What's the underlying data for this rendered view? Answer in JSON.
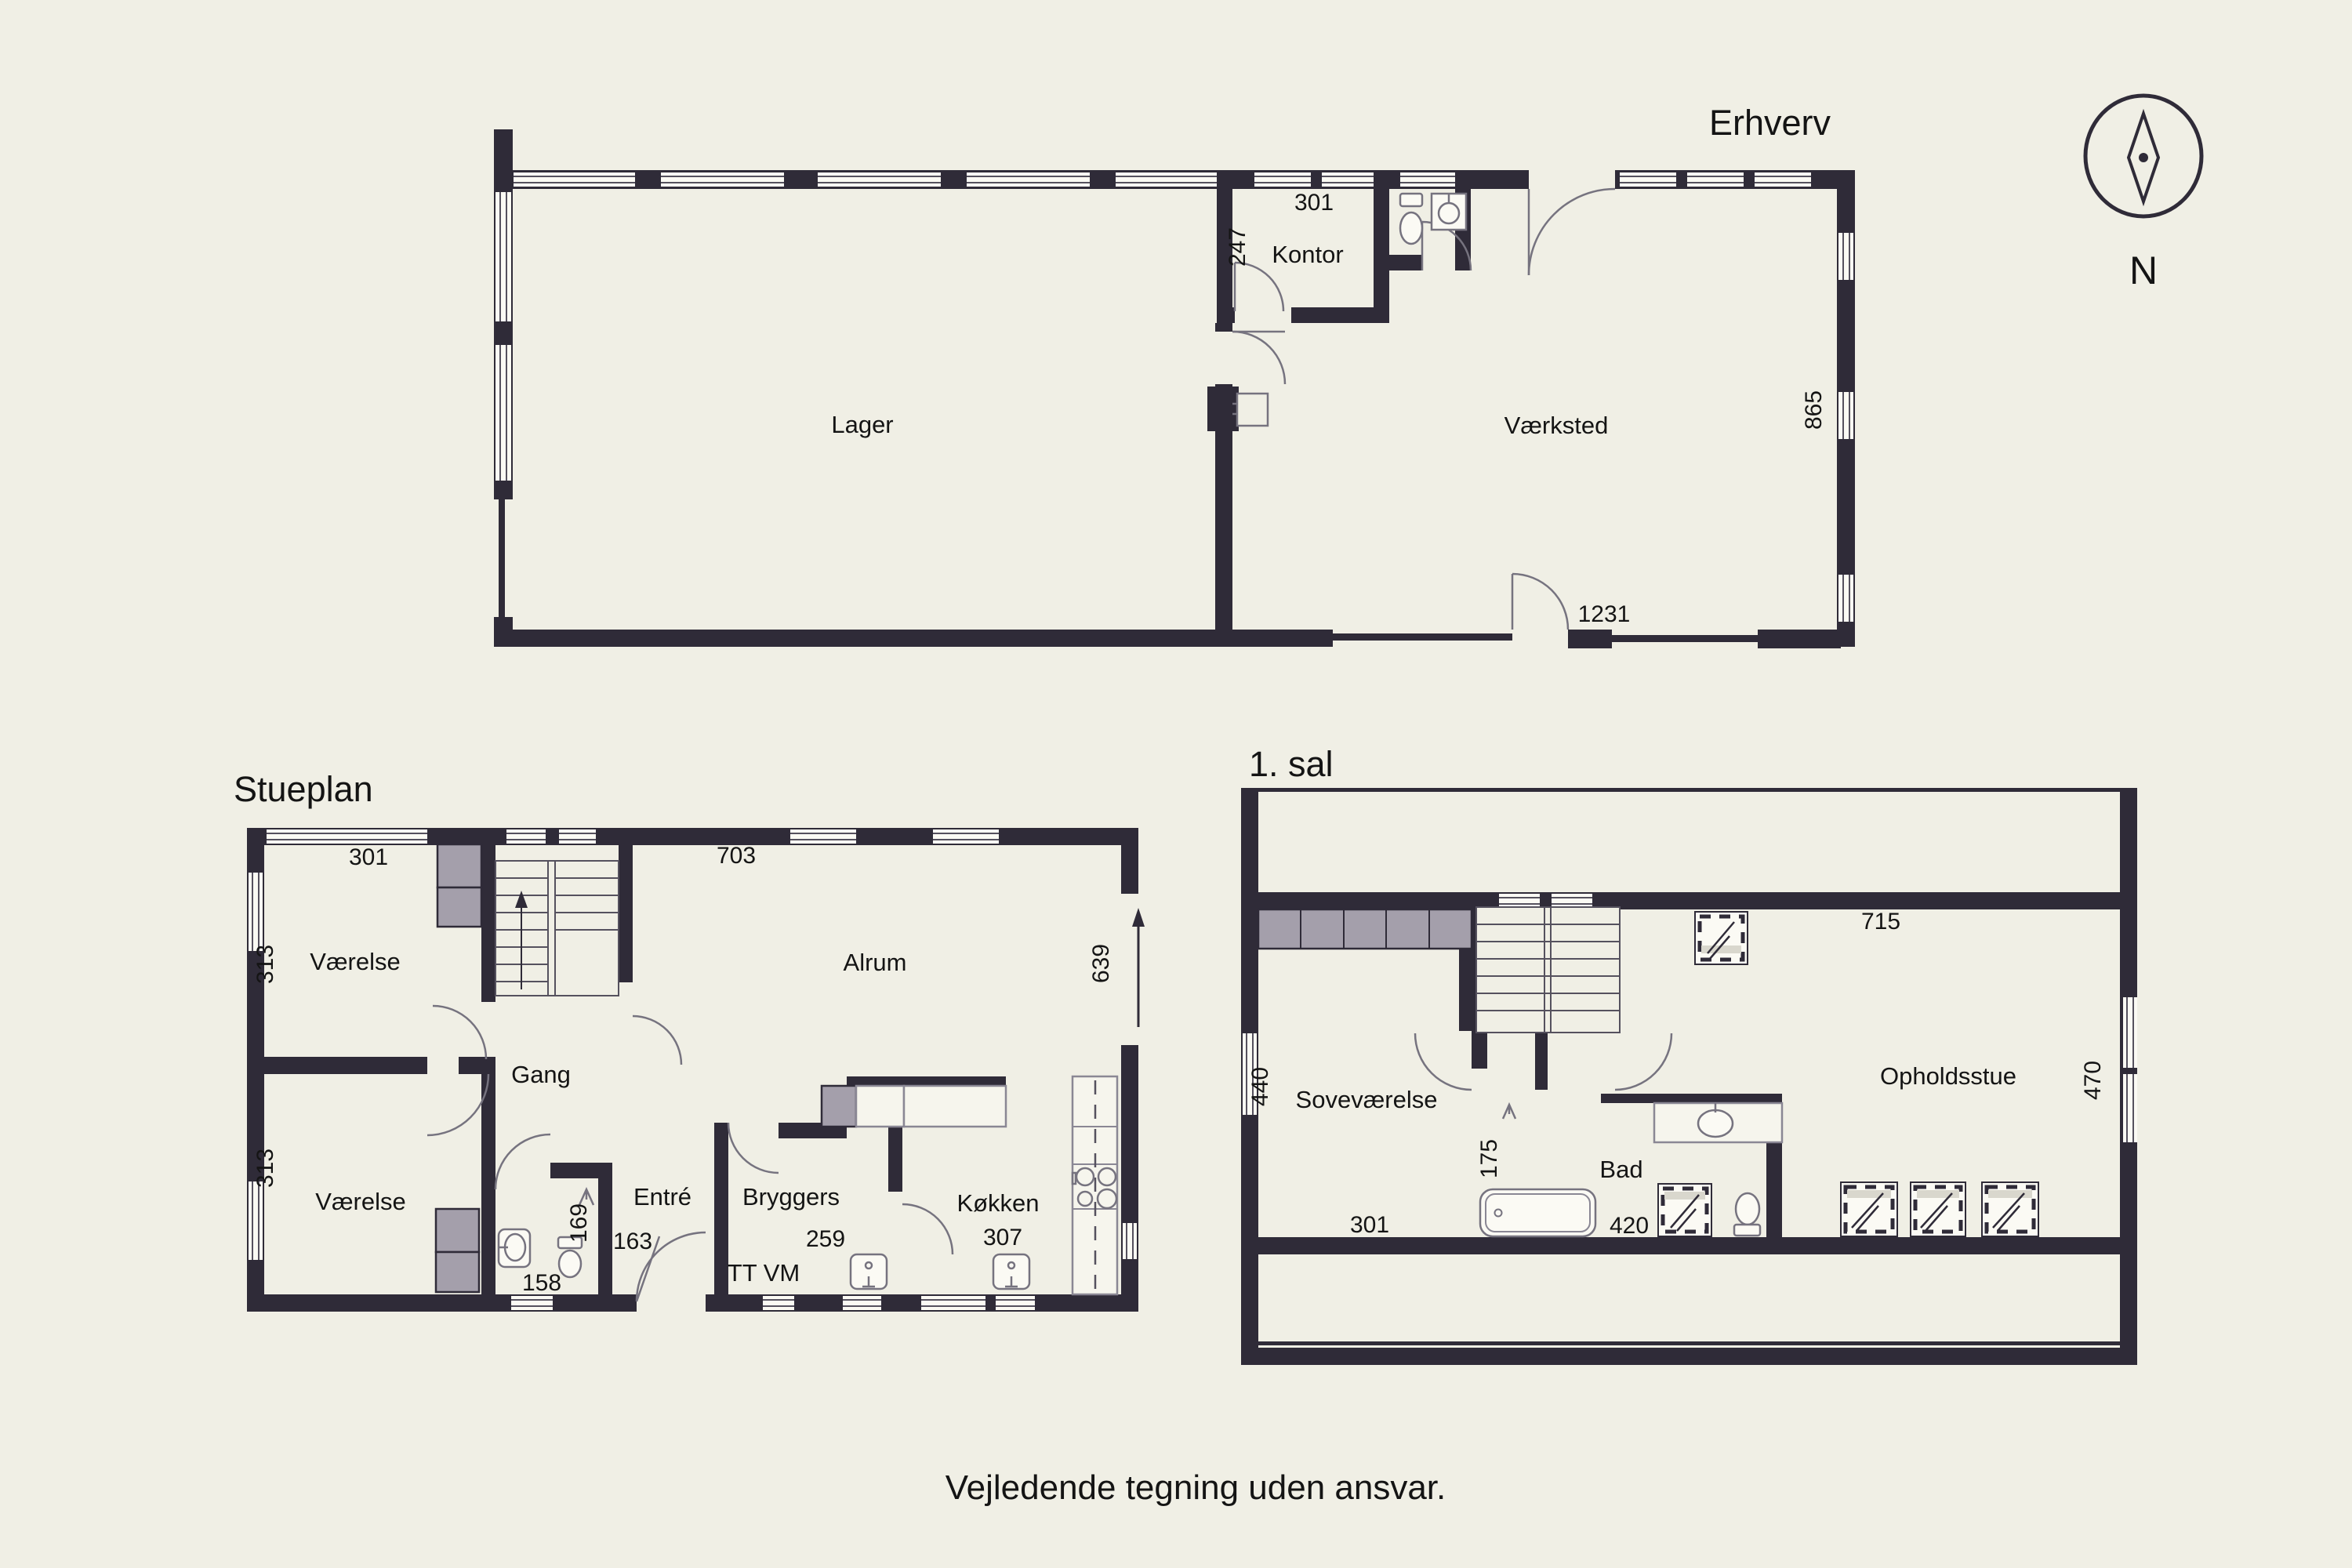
{
  "footer": {
    "text": "Vejledende tegning uden ansvar."
  },
  "compass": {
    "label": "N"
  },
  "colors": {
    "background": "#f0efe5",
    "wall": "#2f2b38",
    "furniture_gray": "#a49fab",
    "fixture_stroke": "#8a8794",
    "window_white": "#fbfaf4",
    "text": "#141414"
  },
  "erhverv": {
    "title": "Erhverv",
    "rooms": {
      "lager": "Lager",
      "kontor": "Kontor",
      "vaerksted": "Værksted"
    },
    "dims": {
      "kontor_w": "301",
      "kontor_d": "247",
      "right": "865",
      "bottom": "1231"
    }
  },
  "stueplan": {
    "title": "Stueplan",
    "rooms": {
      "vaerelse1": "Værelse",
      "vaerelse2": "Værelse",
      "gang": "Gang",
      "entre": "Entré",
      "bryggers": "Bryggers",
      "alrum": "Alrum",
      "kokken": "Køkken"
    },
    "dims": {
      "top_left": "301",
      "top_right": "703",
      "left_top": "313",
      "left_bottom": "313",
      "right": "639",
      "wc_depth": "169",
      "entre_w": "163",
      "wc_w": "158",
      "bryggers_w": "259",
      "kokken_w": "307"
    },
    "appliances": "TT VM"
  },
  "sal1": {
    "title": "1. sal",
    "rooms": {
      "sovevaerelse": "Soveværelse",
      "bad": "Bad",
      "opholdsstue": "Opholdsstue"
    },
    "dims": {
      "top": "715",
      "left": "440",
      "sove_w": "301",
      "landing": "175",
      "bad_w": "420",
      "right": "470"
    }
  }
}
